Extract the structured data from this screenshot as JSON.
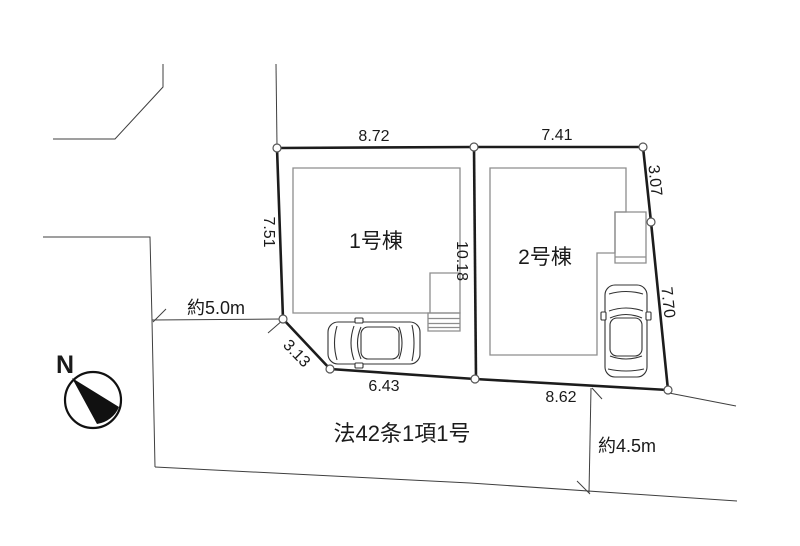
{
  "compass": {
    "north_label": "N"
  },
  "buildings": {
    "building1_label": "1号棟",
    "building2_label": "2号棟"
  },
  "dimensions": {
    "lot1_top": "8.72",
    "lot2_top": "7.41",
    "right_upper": "3.07",
    "right_lower": "7.70",
    "lot2_bottom": "8.62",
    "lot1_bottom": "6.43",
    "sw_diagonal": "3.13",
    "west_side": "7.51",
    "center_divider": "10.18"
  },
  "roads": {
    "west_road_width": "約5.0m",
    "south_road_width": "約4.5m",
    "road_designation": "法42条1項1号"
  },
  "colors": {
    "line": "#1c1c1c",
    "building_line": "#8d8d8d",
    "background": "#ffffff"
  }
}
